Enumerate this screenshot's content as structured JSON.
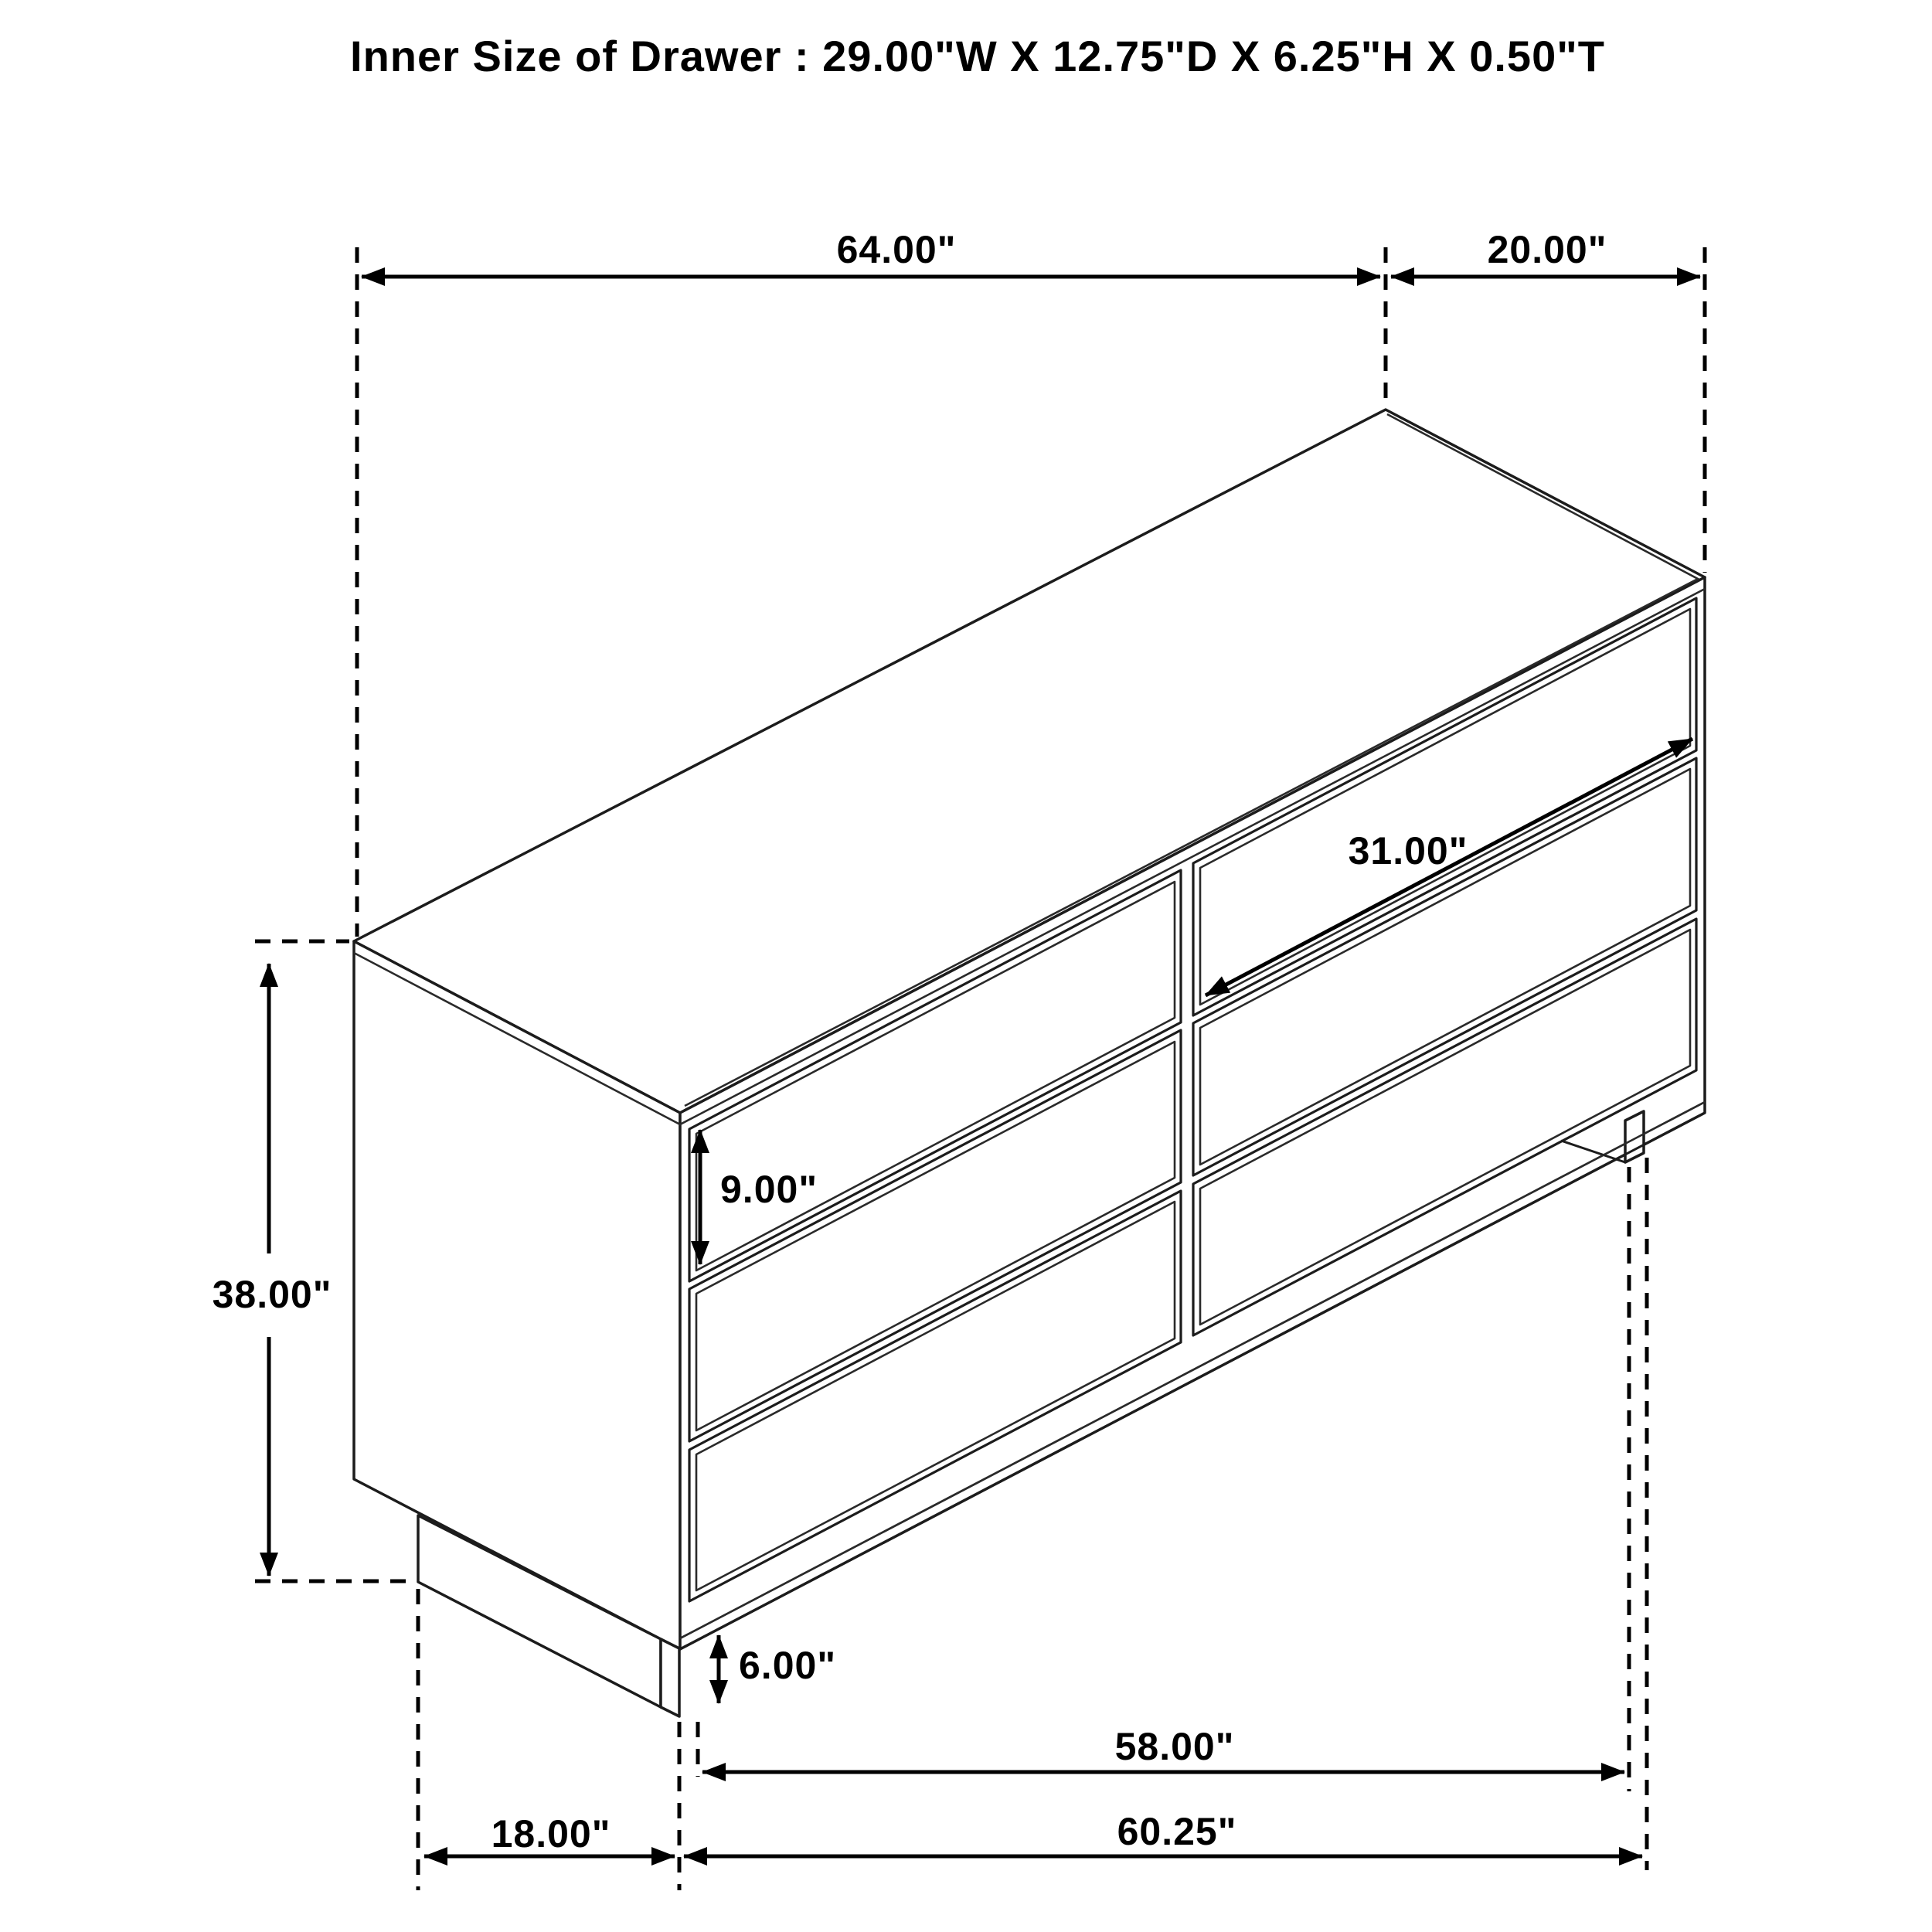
{
  "title": "Inner Size of Drawer : 29.00\"W X 12.75\"D X 6.25\"H X 0.50\"T",
  "dimensions": {
    "overall_width": "64.00\"",
    "overall_depth": "20.00\"",
    "overall_height": "38.00\"",
    "drawer_width": "31.00\"",
    "drawer_front_height": "9.00\"",
    "base_height": "6.00\"",
    "leg_inner_span": "58.00\"",
    "leg_outer_span": "60.25\"",
    "base_depth": "18.00\""
  },
  "style": {
    "line_color": "#1c1c1c",
    "dimension_color": "#000000",
    "background": "#ffffff"
  }
}
